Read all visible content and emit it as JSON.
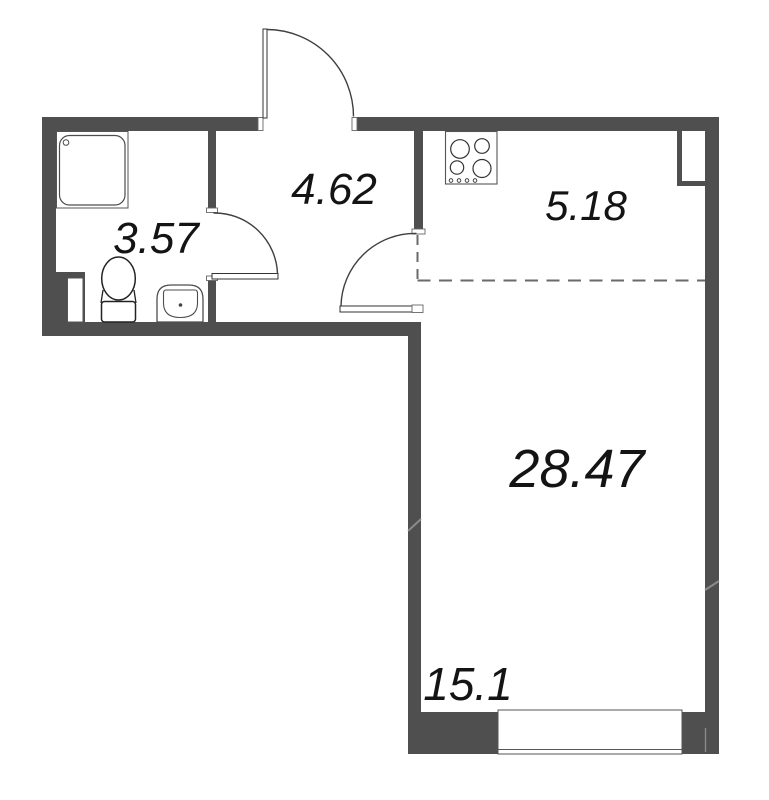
{
  "colors": {
    "wall": "#4f4f4f",
    "door_line": "#3f3f3f",
    "text": "#141414",
    "background": "#ffffff"
  },
  "rooms": {
    "bathroom": {
      "area": "3.57"
    },
    "hallway": {
      "area": "4.62"
    },
    "kitchen_zone": {
      "area": "5.18"
    },
    "living_room": {
      "area": "28.47"
    },
    "living_zone": {
      "area": "15.1"
    }
  },
  "icons": {
    "shower": "shower-tray-icon",
    "toilet": "toilet-icon",
    "sink": "sink-icon",
    "stove": "stove-4-burner-icon",
    "window": "window-symbol",
    "doors": [
      "entrance-door-arc",
      "bathroom-door-arc",
      "room-door-arc"
    ]
  }
}
